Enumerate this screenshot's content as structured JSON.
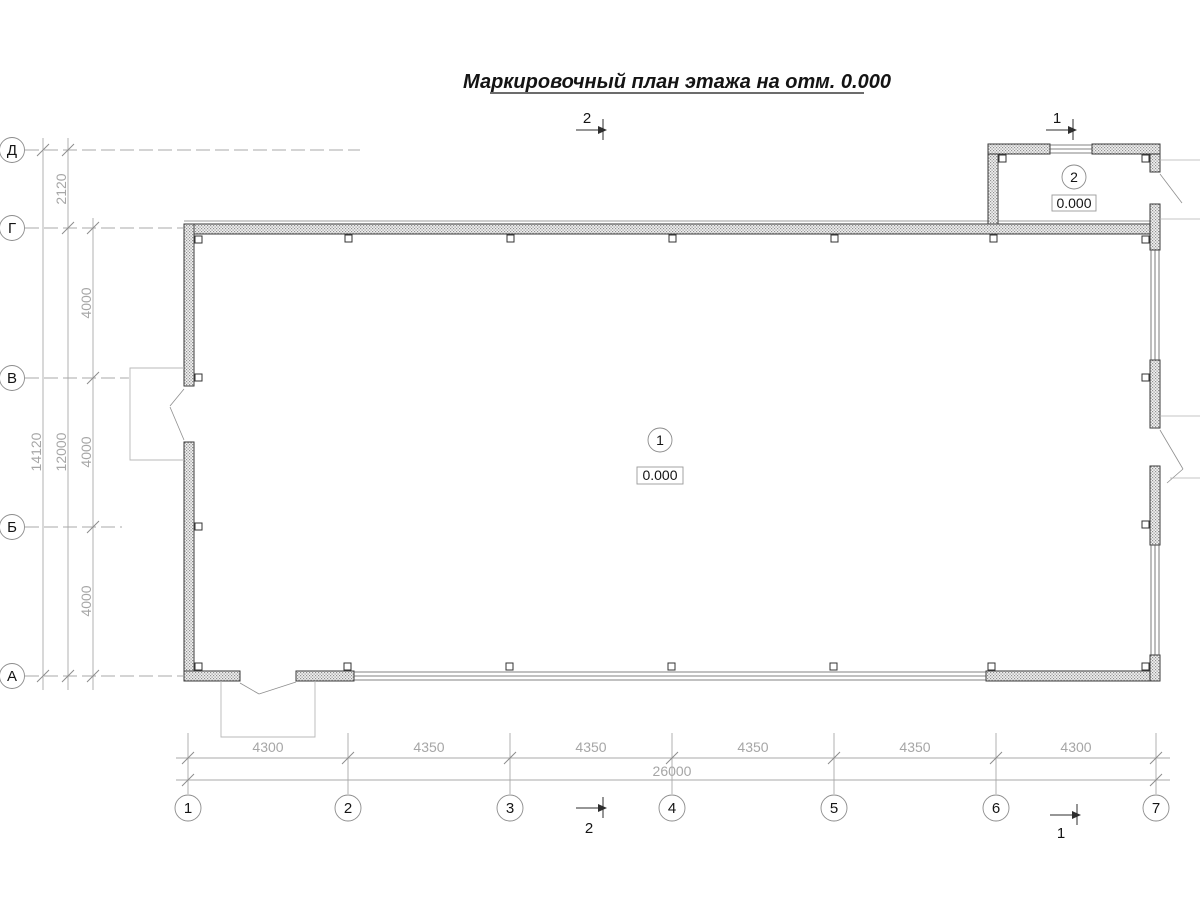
{
  "title": "Маркировочный план этажа на отм. 0.000",
  "grid": {
    "row_labels": [
      "Д",
      "Г",
      "В",
      "Б",
      "А"
    ],
    "col_labels": [
      "1",
      "2",
      "3",
      "4",
      "5",
      "6",
      "7"
    ]
  },
  "dimensions": {
    "left": {
      "overall": "14120",
      "inner": "12000",
      "segments": [
        "2120",
        "4000",
        "4000",
        "4000"
      ]
    },
    "bottom": {
      "segments": [
        "4300",
        "4350",
        "4350",
        "4350",
        "4350",
        "4300"
      ],
      "overall": "26000"
    }
  },
  "markers": {
    "room1": {
      "number": "1",
      "level": "0.000"
    },
    "room2": {
      "number": "2",
      "level": "0.000"
    }
  },
  "sections": {
    "sec1": "1",
    "sec2": "2"
  }
}
